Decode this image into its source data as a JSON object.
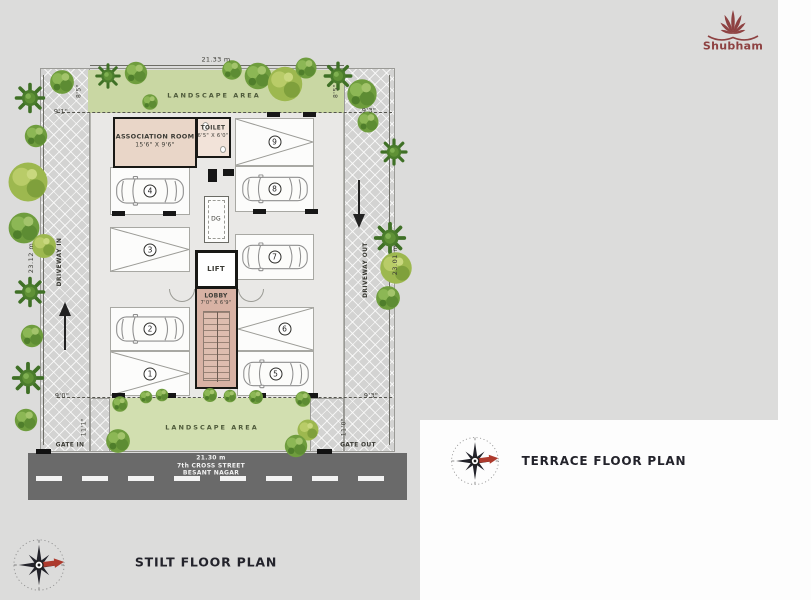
{
  "logo": {
    "name": "Shubham"
  },
  "colors": {
    "background_gray": "#dcdcdb",
    "landscape_green": "#c9d7a3",
    "building_floor": "#e9e8e6",
    "lobby_pink": "#d8b2a4",
    "terrace_floor": "#eedbd0",
    "road_gray": "#6a6a6a",
    "wall_black": "#181815",
    "brand_maroon": "#8e4242",
    "compass_needle_red": "#ad3a2d",
    "tree_green": "#6f9d3e"
  },
  "stilt_plan": {
    "title": "STILT FLOOR PLAN",
    "dims": {
      "top_width": "21.33 m",
      "bottom_width": "21.30 m",
      "left_height": "23.12 m",
      "right_height": "23.01 m",
      "top_left": "9'1\"",
      "top_right": "9'3\"",
      "bottom_left": "9'0\"",
      "bottom_right": "9'3\"",
      "landscape_left": "8'5\"",
      "landscape_right": "8'5\"",
      "gate_in": "11'1\"",
      "gate_out": "11'0\""
    },
    "labels": {
      "landscape_top": "LANDSCAPE AREA",
      "landscape_bottom": "LANDSCAPE AREA",
      "driveway_in": "DRIVEWAY IN",
      "driveway_out": "DRIVEWAY OUT",
      "gate_in": "GATE IN",
      "gate_out": "GATE OUT"
    },
    "street": {
      "line1": "7th CROSS STREET",
      "line2": "BESANT NAGAR"
    },
    "rooms": {
      "association": {
        "name": "ASSOCIATION ROOM",
        "size": "15'6\" X 9'6\""
      },
      "toilet": {
        "name": "TOILET",
        "size": "6'5\" X 6'0\""
      },
      "dg": "DG",
      "lift": "LIFT",
      "lobby": {
        "name": "LOBBY",
        "size": "7'0\" X 6'9\""
      }
    },
    "parking": [
      {
        "no": "1",
        "occupied": false
      },
      {
        "no": "2",
        "occupied": true
      },
      {
        "no": "3",
        "occupied": false
      },
      {
        "no": "4",
        "occupied": true
      },
      {
        "no": "5",
        "occupied": true
      },
      {
        "no": "6",
        "occupied": false
      },
      {
        "no": "7",
        "occupied": true
      },
      {
        "no": "8",
        "occupied": true
      },
      {
        "no": "9",
        "occupied": false
      }
    ]
  },
  "terrace_plan": {
    "title": "TERRACE FLOOR PLAN",
    "labels": {
      "open_terrace": "OPEN TERRACE"
    },
    "rooms": {
      "ots": "OTS",
      "lift": "LIFT",
      "lobby": {
        "name": "LOBBY",
        "size": "7'0\" X 6'9\""
      }
    }
  }
}
